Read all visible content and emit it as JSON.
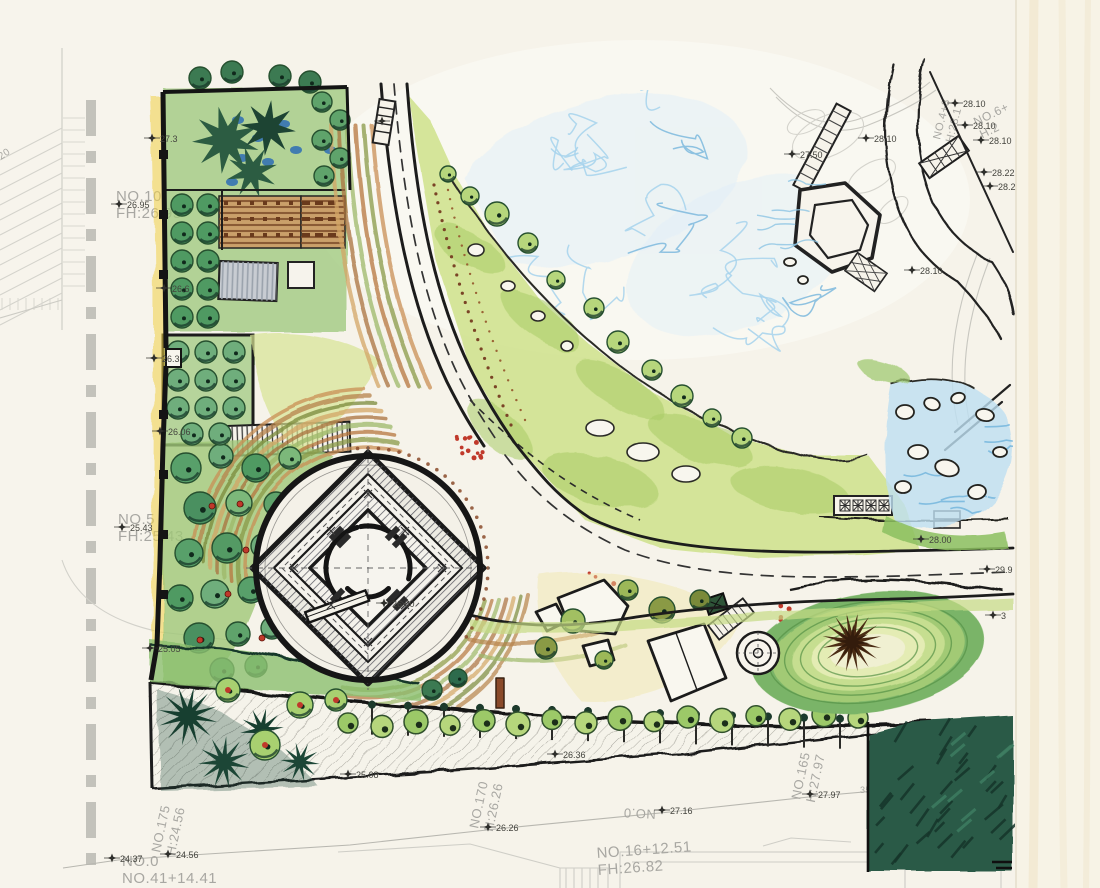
{
  "artwork": {
    "kind": "hand-drawn landscape master plan, watercolor and ink over gray CAD survey base"
  },
  "colors": {
    "paper": "#f6f3ea",
    "paper_light": "#fbfaf4",
    "margin": "#f7f3e6",
    "ink": "#1c1c1c",
    "cad_line": "#cccbc4",
    "cad_text": "#a8a7a2",
    "cad_text_dark": "#44443e",
    "lawn": "#cfe28c",
    "lawn_dark": "#a9cc66",
    "tree_green": "#5fa36b",
    "tree_light": "#b6d67c",
    "tree_dark": "#2d6b4c",
    "tree_shadow": "#17382a",
    "olive": "#8a9a45",
    "water": "#a6d2ec",
    "water_deep": "#79b8de",
    "cobalt": "#2d6db5",
    "earth": "#c98f54",
    "earth_dark": "#9a6335",
    "rust": "#7a4426",
    "yellow": "#f2d246",
    "red": "#c0392b",
    "berm1": "#7ab468",
    "berm2": "#a2ca74",
    "berm3": "#c6de90",
    "berm4": "#e4ecb4",
    "berm_core": "#f0f0d2",
    "corner_green": "#2c5a47",
    "corner_dark": "#16352a"
  },
  "annotations": {
    "station_labels": [
      {
        "lines": [
          "NO.10",
          "FH:26.95"
        ],
        "x": 116,
        "y": 201,
        "rot": 0,
        "size": 15
      },
      {
        "lines": [
          "NO.5",
          "FH:25.43"
        ],
        "x": 118,
        "y": 524,
        "rot": 0,
        "size": 15
      },
      {
        "lines": [
          "NO.175",
          "H:24.56"
        ],
        "x": 160,
        "y": 853,
        "rot": -78,
        "size": 13
      },
      {
        "lines": [
          "NO.0",
          "NO.41+14.41"
        ],
        "x": 122,
        "y": 866,
        "rot": 0,
        "size": 15
      },
      {
        "lines": [
          "NO.170",
          "H:26.26"
        ],
        "x": 478,
        "y": 829,
        "rot": -78,
        "size": 13
      },
      {
        "lines": [
          "NO.0"
        ],
        "x": 656,
        "y": 810,
        "rot": 183,
        "size": 13
      },
      {
        "lines": [
          "NO.16+12.51",
          "FH:26.82"
        ],
        "x": 597,
        "y": 858,
        "rot": -4,
        "size": 15
      },
      {
        "lines": [
          "NO.165",
          "H:27.97"
        ],
        "x": 800,
        "y": 800,
        "rot": -78,
        "size": 13
      },
      {
        "lines": [
          "35.37+"
        ],
        "x": 860,
        "y": 793,
        "rot": 0,
        "size": 9
      },
      {
        "lines": [
          "NO.4+8",
          "H:28.1"
        ],
        "x": 940,
        "y": 140,
        "rot": -76,
        "size": 11
      },
      {
        "lines": [
          "NO.6+",
          "H:2"
        ],
        "x": 976,
        "y": 126,
        "rot": -26,
        "size": 12
      },
      {
        "lines": [
          "20"
        ],
        "x": 1,
        "y": 160,
        "rot": -35,
        "size": 10
      }
    ],
    "elevation_markers": [
      {
        "v": "26.95",
        "x": 127,
        "y": 207
      },
      {
        "v": "27.3",
        "x": 160,
        "y": 141
      },
      {
        "v": "26.6",
        "x": 172,
        "y": 291
      },
      {
        "v": "26.3",
        "x": 162,
        "y": 361
      },
      {
        "v": "26.06",
        "x": 168,
        "y": 434
      },
      {
        "v": "25.43",
        "x": 130,
        "y": 530
      },
      {
        "v": "25.05",
        "x": 158,
        "y": 651
      },
      {
        "v": "26.36",
        "x": 563,
        "y": 757
      },
      {
        "v": "25.08",
        "x": 356,
        "y": 777
      },
      {
        "v": "24.37",
        "x": 120,
        "y": 861
      },
      {
        "v": "24.56",
        "x": 176,
        "y": 857
      },
      {
        "v": "26.26",
        "x": 496,
        "y": 830
      },
      {
        "v": "27.16",
        "x": 670,
        "y": 813
      },
      {
        "v": "27.97",
        "x": 818,
        "y": 797
      },
      {
        "v": "26.00",
        "x": 392,
        "y": 606
      },
      {
        "v": "27.50",
        "x": 800,
        "y": 157
      },
      {
        "v": "28.10",
        "x": 874,
        "y": 141
      },
      {
        "v": "28.10",
        "x": 920,
        "y": 273
      },
      {
        "v": "28.10",
        "x": 963,
        "y": 106
      },
      {
        "v": "28.10",
        "x": 973,
        "y": 128
      },
      {
        "v": "28.10",
        "x": 989,
        "y": 143
      },
      {
        "v": "28.22",
        "x": 992,
        "y": 175
      },
      {
        "v": "28.2",
        "x": 998,
        "y": 189
      },
      {
        "v": "28.00",
        "x": 929,
        "y": 542
      },
      {
        "v": "29.9",
        "x": 995,
        "y": 572
      },
      {
        "v": "3",
        "x": 1001,
        "y": 618
      },
      {
        "v": "",
        "x": 390,
        "y": 124
      }
    ]
  }
}
